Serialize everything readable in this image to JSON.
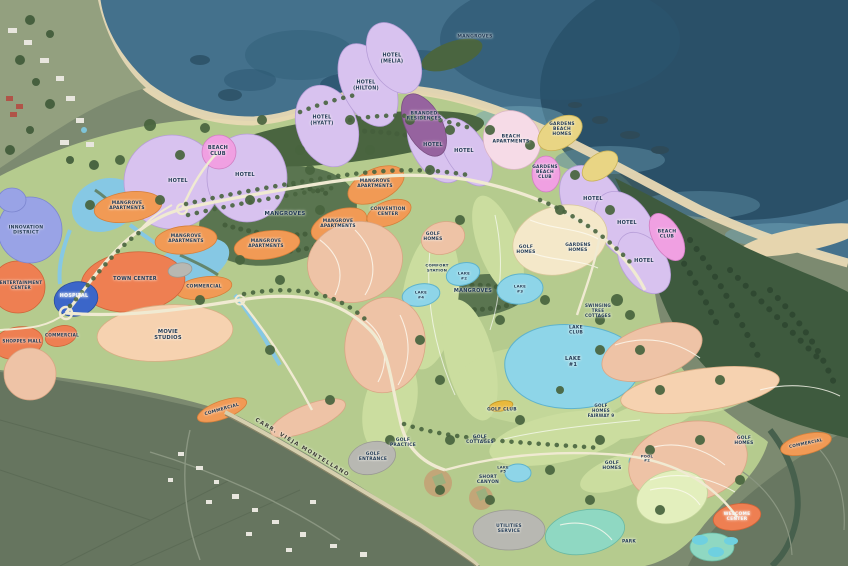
{
  "map": {
    "description": "Resort and golf community master plan over aerial photography, coastline at top",
    "road_name": "CARR. VIEJA MONTELLANO",
    "labels": [
      {
        "name": "label-mangroves-north",
        "text": "MANGROVES",
        "x": 475,
        "y": 37,
        "size": 4.6
      },
      {
        "name": "label-hotel-melia",
        "text": "HOTEL\n(MELIA)",
        "x": 392,
        "y": 59,
        "size": 4.8
      },
      {
        "name": "label-hotel-hilton",
        "text": "HOTEL\n(HILTON)",
        "x": 366,
        "y": 86,
        "size": 4.8
      },
      {
        "name": "label-hotel-hyatt",
        "text": "HOTEL\n(HYATT)",
        "x": 322,
        "y": 121,
        "size": 4.8
      },
      {
        "name": "label-branded-residences",
        "text": "BRANDED\nRESIDENCES",
        "x": 424,
        "y": 117,
        "size": 4.6
      },
      {
        "name": "label-hotel-1",
        "text": "HOTEL",
        "x": 178,
        "y": 182,
        "size": 5
      },
      {
        "name": "label-hotel-2",
        "text": "HOTEL",
        "x": 245,
        "y": 176,
        "size": 5
      },
      {
        "name": "label-hotel-3",
        "text": "HOTEL",
        "x": 433,
        "y": 146,
        "size": 5
      },
      {
        "name": "label-hotel-4",
        "text": "HOTEL",
        "x": 464,
        "y": 152,
        "size": 5
      },
      {
        "name": "label-beach-club-west",
        "text": "BEACH\nCLUB",
        "x": 218,
        "y": 152,
        "size": 5
      },
      {
        "name": "label-beach-apartments",
        "text": "BEACH\nAPARTMENTS",
        "x": 511,
        "y": 140,
        "size": 4.6
      },
      {
        "name": "label-gardens-beach-homes",
        "text": "GARDENS\nBEACH\nHOMES",
        "x": 562,
        "y": 130,
        "size": 4.4
      },
      {
        "name": "label-gardens-beach-club",
        "text": "GARDENS\nBEACH\nCLUB",
        "x": 545,
        "y": 173,
        "size": 4.4
      },
      {
        "name": "label-hotel-5",
        "text": "HOTEL",
        "x": 593,
        "y": 200,
        "size": 5
      },
      {
        "name": "label-hotel-6",
        "text": "HOTEL",
        "x": 627,
        "y": 224,
        "size": 5
      },
      {
        "name": "label-hotel-7",
        "text": "HOTEL",
        "x": 644,
        "y": 262,
        "size": 5
      },
      {
        "name": "label-beach-club-east",
        "text": "BEACH\nCLUB",
        "x": 667,
        "y": 235,
        "size": 4.6
      },
      {
        "name": "label-mangroves-west",
        "text": "MANGROVES",
        "x": 285,
        "y": 214,
        "size": 5.4
      },
      {
        "name": "label-mangroves-center",
        "text": "MANGROVES",
        "x": 473,
        "y": 292,
        "size": 5
      },
      {
        "name": "label-mangrove-apartments-1",
        "text": "MANGROVE\nAPARTMENTS",
        "x": 127,
        "y": 206,
        "size": 4.4
      },
      {
        "name": "label-mangrove-apartments-2",
        "text": "MANGROVE\nAPARTMENTS",
        "x": 186,
        "y": 239,
        "size": 4.4
      },
      {
        "name": "label-mangrove-apartments-3",
        "text": "MANGROVE\nAPARTMENTS",
        "x": 266,
        "y": 244,
        "size": 4.4
      },
      {
        "name": "label-mangrove-apartments-4",
        "text": "MANGROVE\nAPARTMENTS",
        "x": 338,
        "y": 224,
        "size": 4.4
      },
      {
        "name": "label-mangrove-apartments-5",
        "text": "MANGROVE\nAPARTMENTS",
        "x": 375,
        "y": 184,
        "size": 4.4
      },
      {
        "name": "label-convention-center",
        "text": "CONVENTION\nCENTER",
        "x": 388,
        "y": 212,
        "size": 4.4
      },
      {
        "name": "label-innovation-district",
        "text": "INNOVATION\nDISTRICT",
        "x": 26,
        "y": 231,
        "size": 4.6
      },
      {
        "name": "label-entertainment-center",
        "text": "ENTERTAINMENT\nCENTER",
        "x": 21,
        "y": 286,
        "size": 4.2
      },
      {
        "name": "label-town-center",
        "text": "TOWN CENTER",
        "x": 135,
        "y": 280,
        "size": 5
      },
      {
        "name": "label-hospital",
        "text": "HOSPITAL",
        "x": 74,
        "y": 297,
        "size": 4.8,
        "color": "#f4f6f8"
      },
      {
        "name": "label-commercial-1",
        "text": "COMMERCIAL",
        "x": 204,
        "y": 287,
        "size": 4.4
      },
      {
        "name": "label-commercial-2",
        "text": "COMMERCIAL",
        "x": 62,
        "y": 336,
        "size": 4.2
      },
      {
        "name": "label-shoppes-mall",
        "text": "SHOPPES MALL",
        "x": 22,
        "y": 342,
        "size": 4.2
      },
      {
        "name": "label-movie-studios",
        "text": "MOVIE\nSTUDIOS",
        "x": 168,
        "y": 335,
        "size": 5.2
      },
      {
        "name": "label-commercial-3",
        "text": "COMMERCIAL",
        "x": 222,
        "y": 410,
        "size": 4.4,
        "rotate": -16
      },
      {
        "name": "label-carretera-vieja-montellano",
        "text": "CARR. VIEJA MONTELLANO",
        "x": 302,
        "y": 448,
        "size": 5.4,
        "rotate": 31,
        "color": "#3b3b33",
        "spacing": 1.3
      },
      {
        "name": "label-golf-homes-1",
        "text": "GOLF\nHOMES",
        "x": 433,
        "y": 237,
        "size": 4.4
      },
      {
        "name": "label-golf-homes-2",
        "text": "GOLF\nHOMES",
        "x": 526,
        "y": 250,
        "size": 4.4
      },
      {
        "name": "label-gardens-homes",
        "text": "GARDENS\nHOMES",
        "x": 578,
        "y": 248,
        "size": 4.4
      },
      {
        "name": "label-comfort-station",
        "text": "COMFORT\nSTATION",
        "x": 437,
        "y": 268,
        "size": 3.9
      },
      {
        "name": "label-lake-2",
        "text": "LAKE\n#2",
        "x": 464,
        "y": 276,
        "size": 3.9
      },
      {
        "name": "label-lake-3",
        "text": "LAKE\n#3",
        "x": 520,
        "y": 289,
        "size": 3.9
      },
      {
        "name": "label-lake-4",
        "text": "LAKE\n#4",
        "x": 421,
        "y": 295,
        "size": 3.9
      },
      {
        "name": "label-swinging-tree-cottages",
        "text": "SWINGING\nTREE\nCOTTAGES",
        "x": 598,
        "y": 311,
        "size": 4.1
      },
      {
        "name": "label-lake-club",
        "text": "LAKE\nCLUB",
        "x": 576,
        "y": 331,
        "size": 4.5
      },
      {
        "name": "label-lake-1",
        "text": "LAKE\n#1",
        "x": 573,
        "y": 362,
        "size": 5.2
      },
      {
        "name": "label-golf-club",
        "text": "GOLF CLUB",
        "x": 502,
        "y": 410,
        "size": 4.4
      },
      {
        "name": "label-golf-cottages",
        "text": "GOLF\nCOTTAGES",
        "x": 480,
        "y": 440,
        "size": 4.4
      },
      {
        "name": "label-golf-practice",
        "text": "GOLF\nPRACTICE",
        "x": 403,
        "y": 443,
        "size": 4.4
      },
      {
        "name": "label-golf-entrance",
        "text": "GOLF\nENTRANCE",
        "x": 373,
        "y": 457,
        "size": 4.4
      },
      {
        "name": "label-short-canyon",
        "text": "SHORT\nCANYON",
        "x": 488,
        "y": 480,
        "size": 4.4
      },
      {
        "name": "label-lake-5",
        "text": "LAKE\n#5",
        "x": 503,
        "y": 470,
        "size": 3.7
      },
      {
        "name": "label-utilities-service",
        "text": "UTILITIES\nSERVICE",
        "x": 509,
        "y": 529,
        "size": 4.4
      },
      {
        "name": "label-golf-homes-fairway-9",
        "text": "GOLF\nHOMES\nFAIRWAY 9",
        "x": 601,
        "y": 411,
        "size": 4.1
      },
      {
        "name": "label-golf-homes-3",
        "text": "GOLF\nHOMES",
        "x": 612,
        "y": 466,
        "size": 4.4
      },
      {
        "name": "label-pool-2",
        "text": "POOL\n#2",
        "x": 647,
        "y": 459,
        "size": 3.7
      },
      {
        "name": "label-golf-homes-4",
        "text": "GOLF\nHOMES",
        "x": 744,
        "y": 441,
        "size": 4.4
      },
      {
        "name": "label-commercial-4",
        "text": "COMMERCIAL",
        "x": 806,
        "y": 444,
        "size": 4.2,
        "rotate": -12
      },
      {
        "name": "label-welcome-center",
        "text": "WELCOME\nCENTER",
        "x": 737,
        "y": 517,
        "size": 4.4,
        "color": "#f4f6f8"
      },
      {
        "name": "label-park",
        "text": "PARK",
        "x": 629,
        "y": 542,
        "size": 4.4
      }
    ],
    "palette": {
      "ocean_deep": "#21465c",
      "ocean_bay": "#44718c",
      "sand": "#e9d9b4",
      "plan_green": "#b5cb8e",
      "fairway_green": "#cbdd9f",
      "forest_dark": "#3e5a3e",
      "mangrove_green": "#56724a",
      "aerial_land": "#6e7d66",
      "hotel_lavender": "#d8c2ef",
      "branded_purple": "#96639f",
      "beach_club_pink": "#f0a0e2",
      "beach_apartments_pink": "#f6dbe7",
      "gardens_yellow": "#e9d584",
      "apartments_orange": "#f19a55",
      "center_red_orange": "#ee7f52",
      "studios_peach": "#f6d2b0",
      "homes_salmon": "#eec3a6",
      "homes_cream": "#f4e8c9",
      "hospital_blue": "#3b66c9",
      "innovation_periwinkle": "#99a3e6",
      "lake_cyan": "#8ed5e8",
      "road_cream": "#f0ead2",
      "gray_parcel": "#b8b8b2"
    }
  }
}
